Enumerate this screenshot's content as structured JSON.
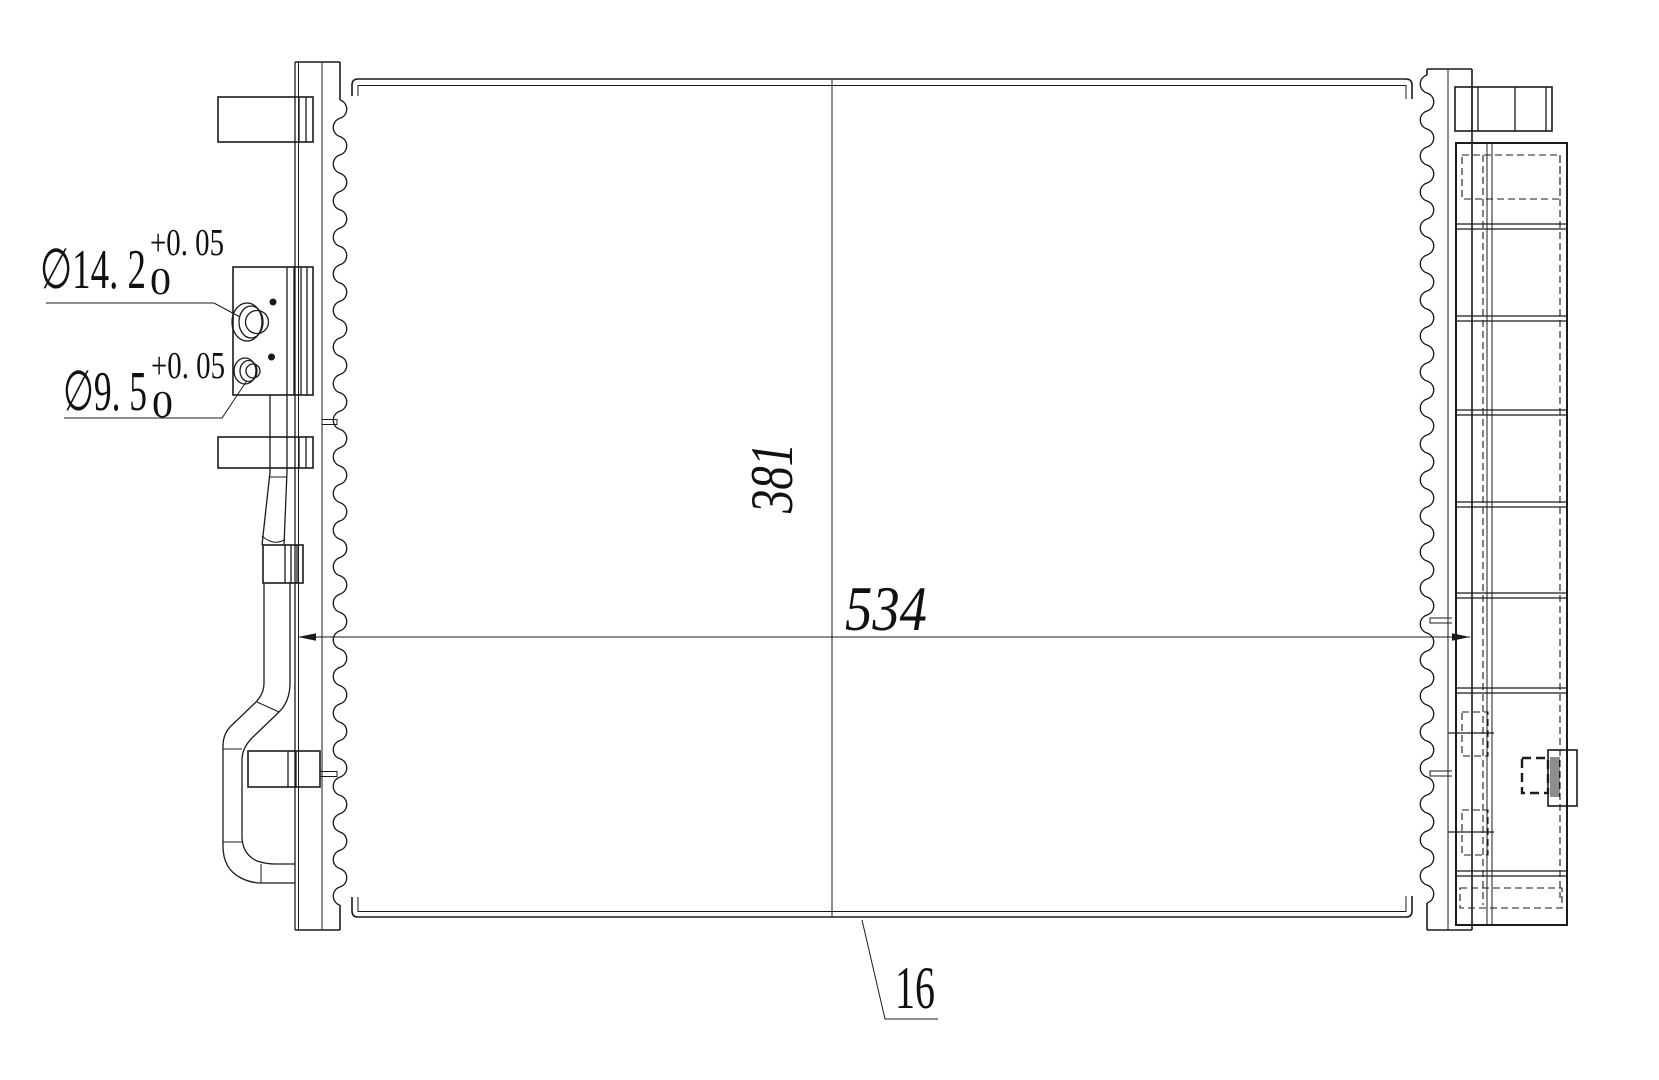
{
  "drawing": {
    "type": "engineering-drawing-condenser",
    "background": "#ffffff",
    "line_color": "#1b1b1b",
    "annotations": {
      "dia_large": {
        "label": "∅14. 2",
        "tol_upper": "+0. 05",
        "tol_lower": "0"
      },
      "dia_small": {
        "label": "∅9. 5",
        "tol_upper": "+0. 05",
        "tol_lower": "0"
      },
      "core_height": "381",
      "core_width": "534",
      "core_thickness": "16"
    }
  }
}
